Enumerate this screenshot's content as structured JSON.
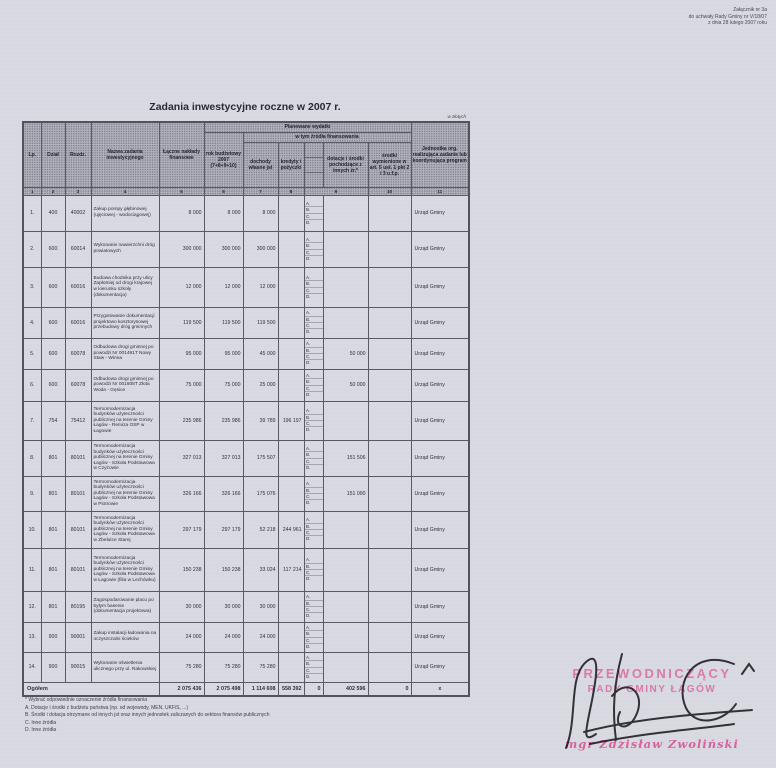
{
  "attachment": {
    "line1": "Załącznik nr 3a",
    "line2": "do uchwały Rady Gminy nr V/18/07",
    "line3": "z dnia 28 lutego 2007 roku"
  },
  "title": "Zadania inwestycyjne roczne w 2007 r.",
  "unit_note": "w złotych",
  "table": {
    "headers": {
      "lp": "Lp.",
      "dzial": "Dział",
      "rozdz": "Rozdz.",
      "nazwa": "Nazwa zadania inwestycyjnego",
      "laczne": "Łączne nakłady finansowe",
      "planowane": "Planowane wydatki",
      "zrodla": "w tym źródła finansowania",
      "rok": "rok budżetowy 2007 (7+8+9+10)",
      "dochody": "dochody własne jst",
      "kredyty": "kredyty i pożyczki",
      "dotacje": "dotacje i środki pochodzące z innych źr.*",
      "srodki": "środki wymienione w art. 5 ust. 1 pkt 2 i 3 u.f.p.",
      "jednostka": "Jednostka org. realizująca zadanie lub koordynująca program"
    },
    "col_numbers": [
      "1",
      "2",
      "3",
      "4",
      "5",
      "6",
      "7",
      "8",
      "9",
      "10",
      "11"
    ],
    "source_letters": [
      "A.",
      "B.",
      "C.",
      "D."
    ],
    "rows": [
      {
        "lp": "1.",
        "dzial": "400",
        "rozdz": "40002",
        "nazwa": "Zakup pompy głębinowej (ujęciowej - wodociągowej)",
        "laczne": "8 000",
        "rok": "8 000",
        "dochody": "8 000",
        "kredyty": "",
        "dotacje": "",
        "srodki": "",
        "jednostka": "Urząd Gminy"
      },
      {
        "lp": "2.",
        "dzial": "600",
        "rozdz": "60014",
        "nazwa": "Wykonanie nawierzchni dróg powiatowych",
        "laczne": "300 000",
        "rok": "300 000",
        "dochody": "300 000",
        "kredyty": "",
        "dotacje": "",
        "srodki": "",
        "jednostka": "Urząd Gminy"
      },
      {
        "lp": "3.",
        "dzial": "600",
        "rozdz": "60016",
        "nazwa": "Budowa chodnika przy ulicy Zapłotniej od drogi krajowej w kierunku szkoły (dokumentacja)",
        "laczne": "12 000",
        "rok": "12 000",
        "dochody": "12 000",
        "kredyty": "",
        "dotacje": "",
        "srodki": "",
        "jednostka": "Urząd Gminy"
      },
      {
        "lp": "4.",
        "dzial": "600",
        "rozdz": "60016",
        "nazwa": "Przygotowanie dokumentacji projektowo kosztorysowej przebudowy dróg gminnych",
        "laczne": "119 500",
        "rok": "119 500",
        "dochody": "119 500",
        "kredyty": "",
        "dotacje": "",
        "srodki": "",
        "jednostka": "Urząd Gminy"
      },
      {
        "lp": "5.",
        "dzial": "600",
        "rozdz": "60078",
        "nazwa": "Odbudowa drogi gminnej po powodzi Nr 001491T Nowy Staw - Winna",
        "laczne": "95 000",
        "rok": "95 000",
        "dochody": "45 000",
        "kredyty": "",
        "dotacje": "50 000",
        "srodki": "",
        "jednostka": "Urząd Gminy"
      },
      {
        "lp": "6.",
        "dzial": "600",
        "rozdz": "60078",
        "nazwa": "Odbudowa drogi gminnej po powodzi Nr 001608T Złota Woda - Gęsice",
        "laczne": "75 000",
        "rok": "75 000",
        "dochody": "25 000",
        "kredyty": "",
        "dotacje": "50 000",
        "srodki": "",
        "jednostka": "Urząd Gminy"
      },
      {
        "lp": "7.",
        "dzial": "754",
        "rozdz": "75412",
        "nazwa": "Termomodernizacja budynków użyteczności publicznej na terenie Gminy Łagów - Remiza OSP w Łagowie",
        "laczne": "235 986",
        "rok": "235 986",
        "dochody": "39 789",
        "kredyty": "196 197",
        "dotacje": "",
        "srodki": "",
        "jednostka": "Urząd Gminy"
      },
      {
        "lp": "8.",
        "dzial": "801",
        "rozdz": "80101",
        "nazwa": "Termomodernizacja budynków użyteczności publicznej na terenie Gminy Łagów - Szkoła Podstawowa w Czyżowie",
        "laczne": "327 013",
        "rok": "327 013",
        "dochody": "175 507",
        "kredyty": "",
        "dotacje": "151 506",
        "srodki": "",
        "jednostka": "Urząd Gminy"
      },
      {
        "lp": "9.",
        "dzial": "801",
        "rozdz": "80101",
        "nazwa": "Termomodernizacja budynków użyteczności publicznej na terenie Gminy Łagów - Szkoła Podstawowa w Piotrowie",
        "laczne": "326 166",
        "rok": "326 166",
        "dochody": "175 076",
        "kredyty": "",
        "dotacje": "151 090",
        "srodki": "",
        "jednostka": "Urząd Gminy"
      },
      {
        "lp": "10.",
        "dzial": "801",
        "rozdz": "80101",
        "nazwa": "Termomodernizacja budynków użyteczności publicznej na terenie Gminy Łagów - Szkoła Podstawowa w Zbelutce Starej",
        "laczne": "297 179",
        "rok": "297 179",
        "dochody": "52 218",
        "kredyty": "244 961",
        "dotacje": "",
        "srodki": "",
        "jednostka": "Urząd Gminy"
      },
      {
        "lp": "11.",
        "dzial": "801",
        "rozdz": "80101",
        "nazwa": "Termomodernizacja budynków użyteczności publicznej na terenie Gminy Łagów - Szkoła Podstawowa w Łagowie (filia w Lechówku)",
        "laczne": "150 238",
        "rok": "150 238",
        "dochody": "33 024",
        "kredyty": "117 214",
        "dotacje": "",
        "srodki": "",
        "jednostka": "Urząd Gminy"
      },
      {
        "lp": "12.",
        "dzial": "801",
        "rozdz": "80195",
        "nazwa": "Zagospodarowanie placu po byłym basenie (dokumentacja projektowa)",
        "laczne": "30 000",
        "rok": "30 000",
        "dochody": "30 000",
        "kredyty": "",
        "dotacje": "",
        "srodki": "",
        "jednostka": "Urząd Gminy"
      },
      {
        "lp": "13.",
        "dzial": "900",
        "rozdz": "90001",
        "nazwa": "Zakup instalacji ładowania na oczyszczalni ścieków",
        "laczne": "24 000",
        "rok": "24 000",
        "dochody": "24 000",
        "kredyty": "",
        "dotacje": "",
        "srodki": "",
        "jednostka": "Urząd Gminy"
      },
      {
        "lp": "14.",
        "dzial": "900",
        "rozdz": "90015",
        "nazwa": "Wykonanie oświetlenia ulicznego przy ul. Rakowskiej",
        "laczne": "75 280",
        "rok": "75 280",
        "dochody": "75 280",
        "kredyty": "",
        "dotacje": "",
        "srodki": "",
        "jednostka": "Urząd Gminy"
      }
    ],
    "total": {
      "label": "Ogółem",
      "laczne": "2 075 436",
      "rok": "2 075 498",
      "dochody": "1 114 608",
      "kredyty": "558 392",
      "letters": "0",
      "dotacje": "402 596",
      "srodki": "0",
      "jednostka": "x"
    }
  },
  "footnotes": {
    "f0": "* Wybrać odpowiednie oznaczenie źródła finansowania",
    "f1": "A. Dotacje i środki z budżetu państwa (np. od wojewody, MEN, UKFiS, ...)",
    "f2": "B. Środki i dotacja otrzymane od innych jst oraz innych jednostek zaliczanych do sektora finansów publicznych",
    "f3": "C. Inne źródła",
    "f4": "D. Inne źródła"
  },
  "stamp": {
    "line1": "PRZEWODNICZĄCY",
    "line2": "RADY GMINY ŁAGÓW",
    "signature": "mgr  Zdzisław  Zwoliński"
  },
  "colors": {
    "paper": "#d8d8e1",
    "stamp_pink": "#d64e90",
    "ink": "#15151a"
  }
}
